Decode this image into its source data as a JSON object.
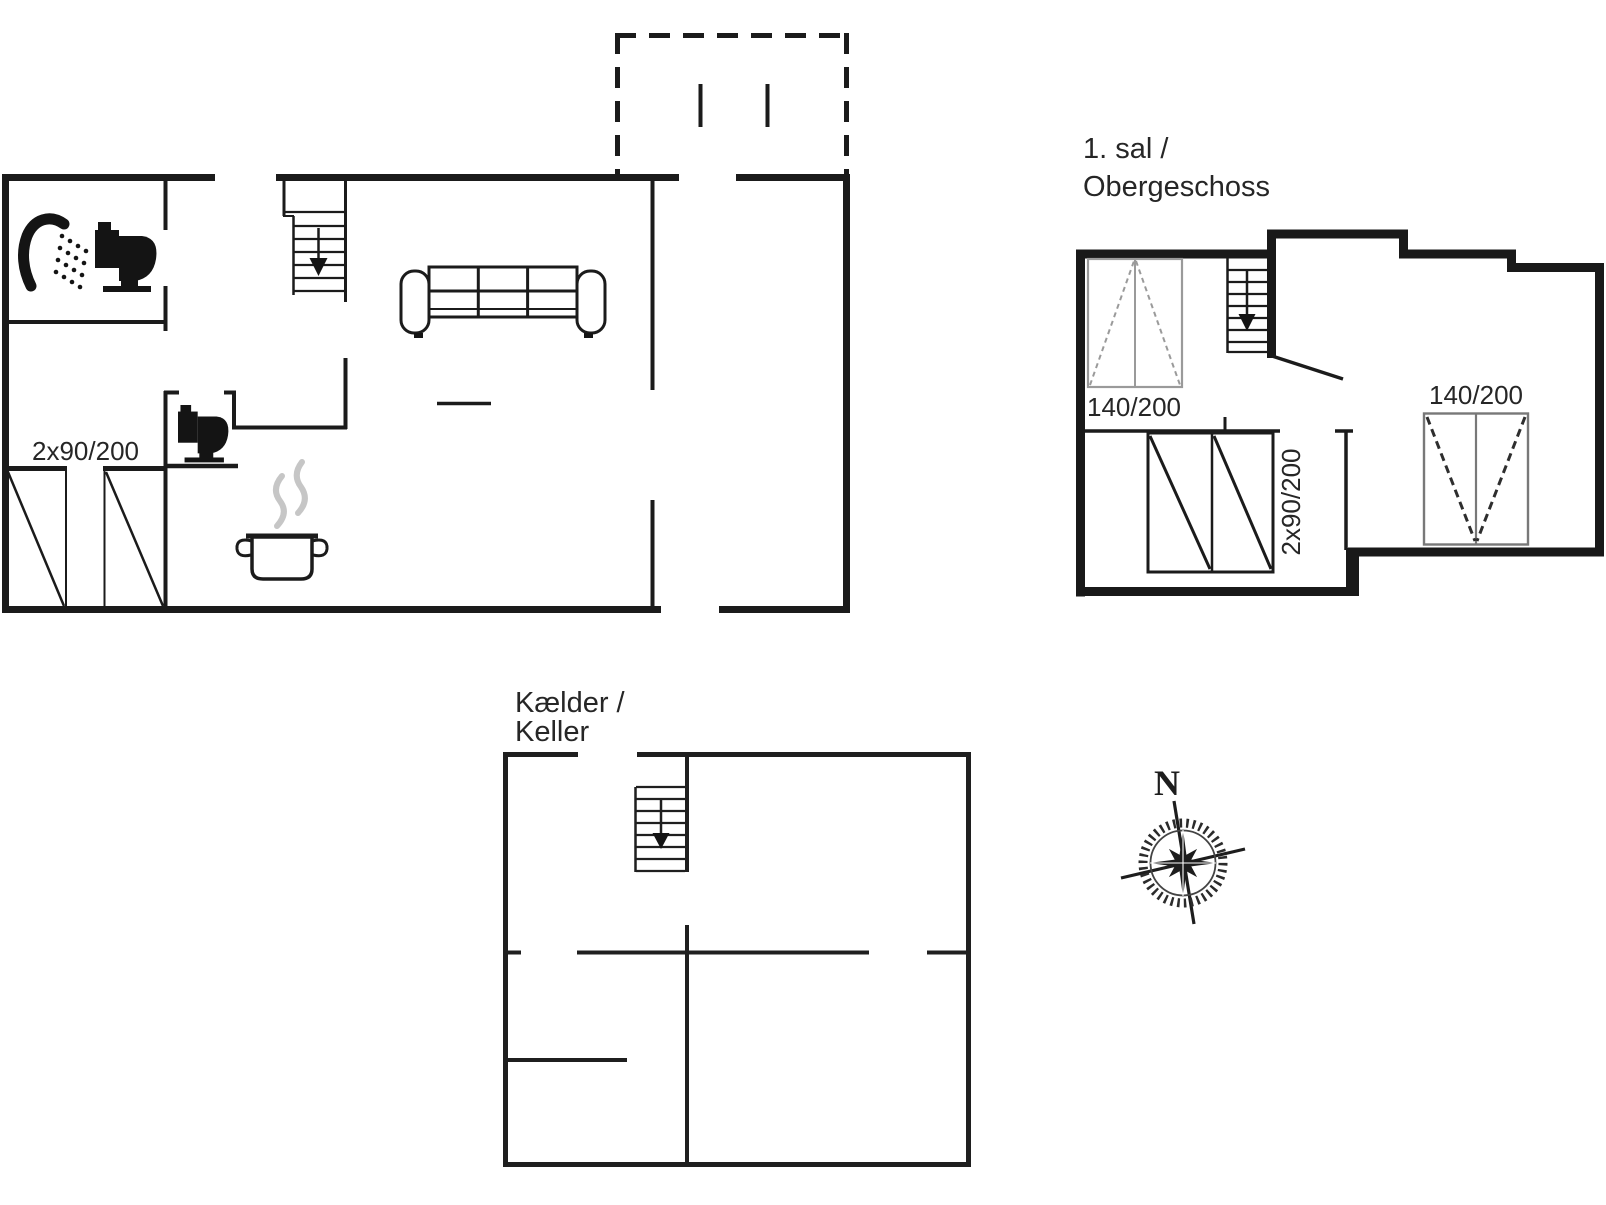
{
  "canvas": {
    "width": 1606,
    "height": 1205,
    "background": "#ffffff"
  },
  "colors": {
    "wall_ink": "#1b1b1b",
    "text": "#262626",
    "bed_gray": "#9a9a9a",
    "bed_frame_gray": "#787878",
    "steam_gray": "#c6c6c6",
    "compass_ink": "#1d1d1d"
  },
  "ground_floor": {
    "bed_label": "2x90/200"
  },
  "upper_floor": {
    "title_line1": "1. sal /",
    "title_line2": "Obergeschoss",
    "left_bed_label": "140/200",
    "right_bed_label": "140/200",
    "double_bed_label": "2x90/200"
  },
  "basement": {
    "title_line1": "Kælder /",
    "title_line2": "Keller"
  },
  "compass": {
    "north_label": "N"
  },
  "icons": {
    "shower": "shower-icon",
    "toilet": "toilet-icon",
    "sofa": "sofa-icon",
    "cooking_pot": "cooking-pot-icon",
    "stairs": "stairs-down-icon",
    "bed": "bed-symbol",
    "terrace": "terrace-dashed-outline",
    "compass": "compass-rose-icon"
  }
}
